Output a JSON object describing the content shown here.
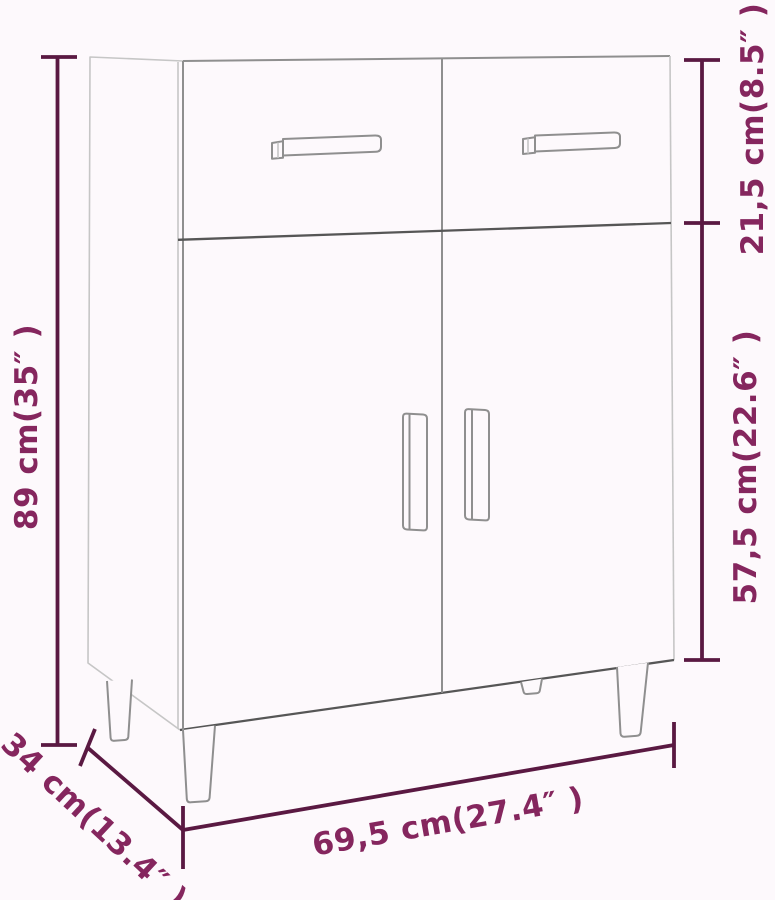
{
  "measurements": {
    "height": {
      "text": "89 cm(35″ )"
    },
    "top_section_height": {
      "text": "21,5 cm(8.5″ )"
    },
    "bottom_section_height": {
      "text": "57,5 cm(22.6″ )"
    },
    "width": {
      "text": "69,5 cm(27.4″ )"
    },
    "depth": {
      "text": "34 cm(13.4″ )"
    }
  },
  "colors": {
    "background": "#fdf9fc",
    "dimension_line": "#5a1942",
    "dimension_text": "#85265e",
    "cabinet_line_light": "#c6c6c6",
    "cabinet_line_mid": "#8f8f8f",
    "cabinet_line_dark": "#565656"
  }
}
